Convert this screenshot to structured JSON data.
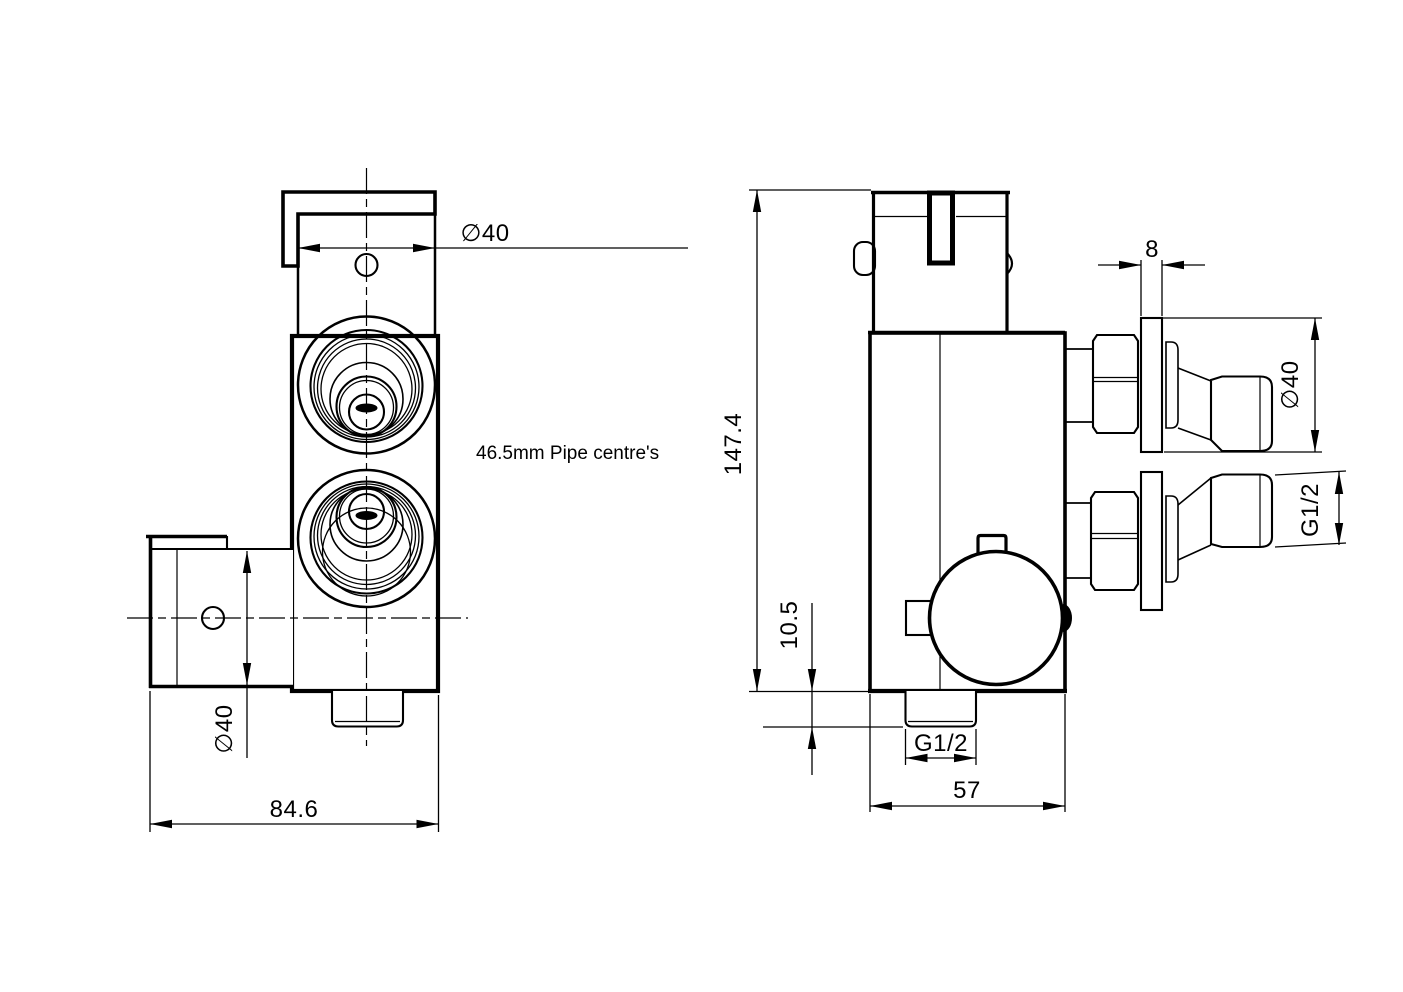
{
  "drawing": {
    "type": "2-view technical dimension drawing of a twin-control thermostatic valve",
    "background_color": "#ffffff",
    "line_color": "#000000"
  },
  "front_view": {
    "top_diameter": "∅40",
    "note": "46.5mm Pipe centre's",
    "side_port_diameter": "∅40",
    "overall_width": "84.6"
  },
  "side_view": {
    "overall_height": "147.4",
    "outlet_protrusion": "10.5",
    "outlet_thread": "G1/2",
    "body_depth": "57",
    "flange_thickness": "8",
    "inlet_flange_diameter": "∅40",
    "inlet_thread": "G1/2"
  }
}
